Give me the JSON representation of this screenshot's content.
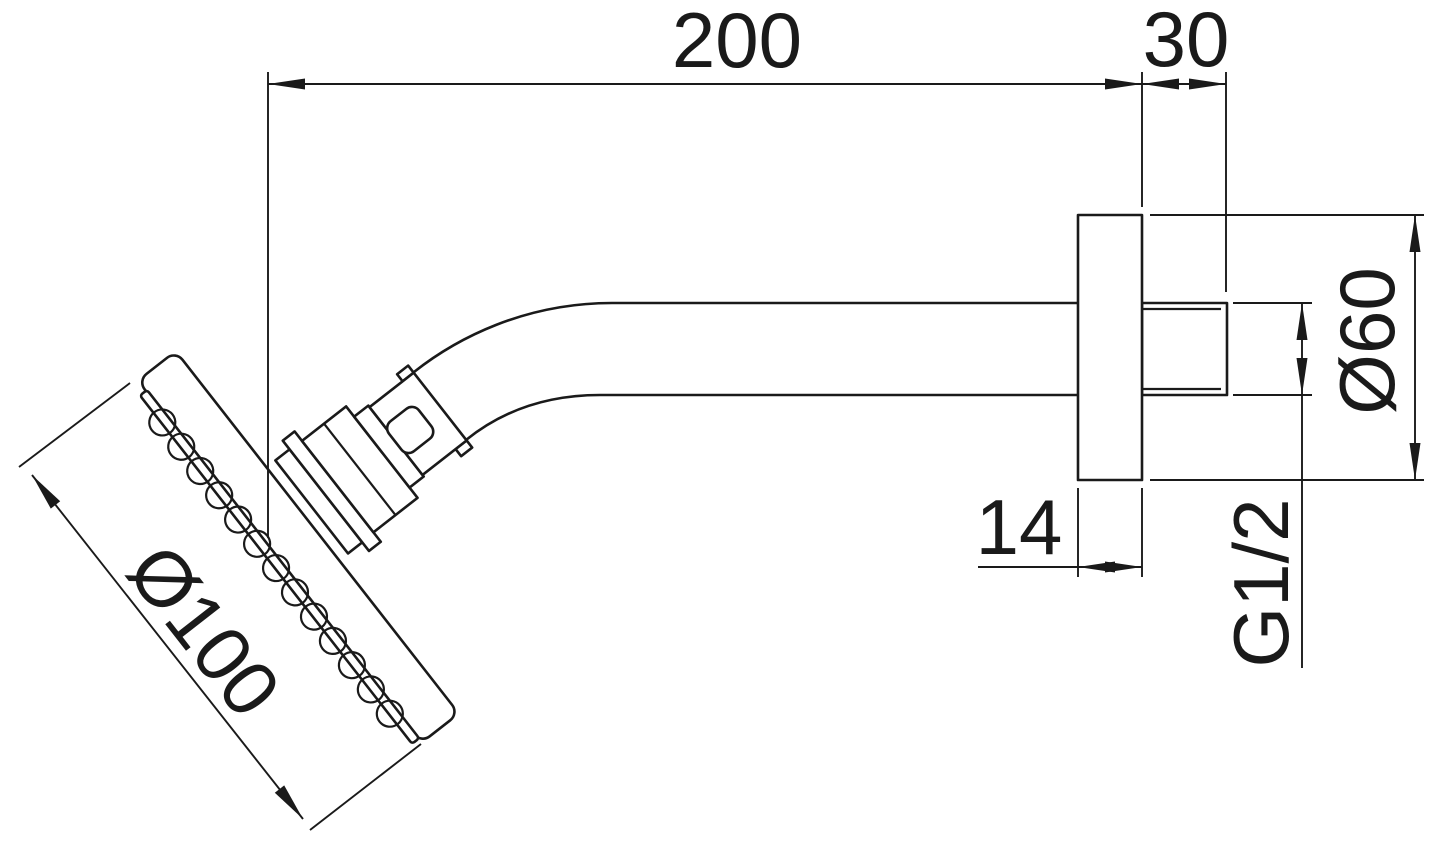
{
  "drawing": {
    "background_color": "#ffffff",
    "line_color": "#1a1a1a",
    "dimensions": {
      "arm_length": "200",
      "wall_stub_length": "30",
      "flange_diameter": "Ø60",
      "thread_size": "G1/2",
      "flange_thickness": "14",
      "head_diameter": "Ø100"
    }
  }
}
